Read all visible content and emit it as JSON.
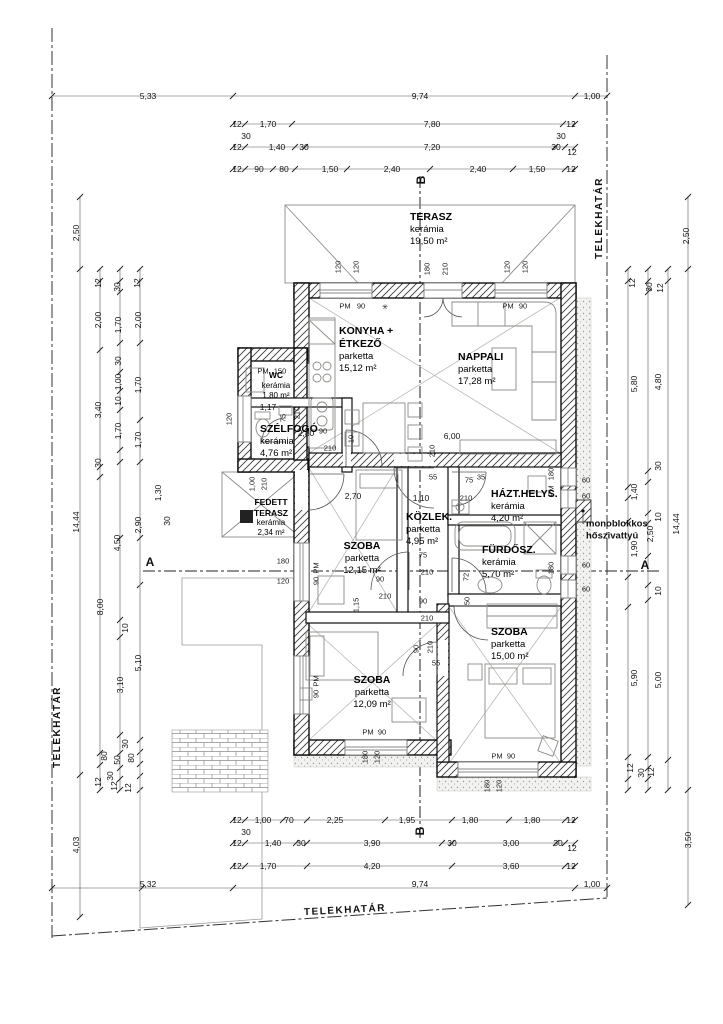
{
  "drawing": {
    "boundary_label": "TELEKHATÁR",
    "annotation": {
      "line1": "monoblokkos",
      "line2": "hőszivattyú"
    },
    "rooms": [
      {
        "name": "TERASZ",
        "floor": "kerámia",
        "area": "19,50 m²",
        "x": 410,
        "y": 211,
        "align": "left",
        "cls": ""
      },
      {
        "name": "KONYHA +",
        "name2": "ÉTKEZŐ",
        "floor": "parketta",
        "area": "15,12 m²",
        "x": 339,
        "y": 325,
        "align": "left",
        "cls": ""
      },
      {
        "name": "NAPPALI",
        "floor": "parketta",
        "area": "17,28 m²",
        "x": 458,
        "y": 351,
        "align": "left",
        "cls": ""
      },
      {
        "name": "WC",
        "floor": "kerámia",
        "area": "1,80 m²",
        "x": 276,
        "y": 370,
        "align": "center",
        "cls": "small"
      },
      {
        "name": "SZÉLFOGÓ",
        "floor": "kerámia",
        "area": "4,76 m²",
        "x": 260,
        "y": 423,
        "align": "left",
        "cls": ""
      },
      {
        "name": "FEDETT",
        "name2": "TERASZ",
        "floor": "kerámia",
        "area": "2,34 m²",
        "x": 271,
        "y": 497,
        "align": "center",
        "cls": "small"
      },
      {
        "name": "SZOBA",
        "floor": "parketta",
        "area": "12,15 m²",
        "x": 362,
        "y": 540,
        "align": "center",
        "cls": ""
      },
      {
        "name": "KÖZLEK.",
        "floor": "parketta",
        "area": "4,95 m²",
        "x": 406,
        "y": 511,
        "align": "left",
        "cls": ""
      },
      {
        "name": "HÁZT.HELYS.",
        "floor": "kerámia",
        "area": "4,20 m²",
        "x": 491,
        "y": 488,
        "align": "left",
        "cls": ""
      },
      {
        "name": "FÜRDŐSZ.",
        "floor": "kerámia",
        "area": "5,70 m²",
        "x": 482,
        "y": 544,
        "align": "left",
        "cls": ""
      },
      {
        "name": "SZOBA",
        "floor": "parketta",
        "area": "12,09 m²",
        "x": 372,
        "y": 674,
        "align": "center",
        "cls": ""
      },
      {
        "name": "SZOBA",
        "floor": "parketta",
        "area": "15,00 m²",
        "x": 491,
        "y": 626,
        "align": "left",
        "cls": ""
      }
    ],
    "labels": [
      {
        "t": "5,33",
        "x": 148,
        "y": 96,
        "c": "dim"
      },
      {
        "t": "9,74",
        "x": 420,
        "y": 96,
        "c": "dim"
      },
      {
        "t": "1,00",
        "x": 592,
        "y": 96,
        "c": "dim"
      },
      {
        "t": "12",
        "x": 237,
        "y": 124,
        "c": "dim"
      },
      {
        "t": "1,70",
        "x": 268,
        "y": 124,
        "c": "dim"
      },
      {
        "t": "7,80",
        "x": 432,
        "y": 124,
        "c": "dim"
      },
      {
        "t": "12",
        "x": 571,
        "y": 124,
        "c": "dim"
      },
      {
        "t": "30",
        "x": 246,
        "y": 136,
        "c": "dim"
      },
      {
        "t": "30",
        "x": 561,
        "y": 136,
        "c": "dim"
      },
      {
        "t": "12",
        "x": 237,
        "y": 147,
        "c": "dim"
      },
      {
        "t": "1,40",
        "x": 277,
        "y": 147,
        "c": "dim"
      },
      {
        "t": "30",
        "x": 304,
        "y": 147,
        "c": "dim"
      },
      {
        "t": "7,20",
        "x": 432,
        "y": 147,
        "c": "dim"
      },
      {
        "t": "30",
        "x": 556,
        "y": 147,
        "c": "dim"
      },
      {
        "t": "12",
        "x": 572,
        "y": 152,
        "c": "dim"
      },
      {
        "t": "12",
        "x": 237,
        "y": 169,
        "c": "dim"
      },
      {
        "t": "90",
        "x": 259,
        "y": 169,
        "c": "dim"
      },
      {
        "t": "80",
        "x": 284,
        "y": 169,
        "c": "dim"
      },
      {
        "t": "1,50",
        "x": 330,
        "y": 169,
        "c": "dim"
      },
      {
        "t": "2,40",
        "x": 392,
        "y": 169,
        "c": "dim"
      },
      {
        "t": "2,40",
        "x": 478,
        "y": 169,
        "c": "dim"
      },
      {
        "t": "1,50",
        "x": 537,
        "y": 169,
        "c": "dim"
      },
      {
        "t": "12",
        "x": 571,
        "y": 169,
        "c": "dim"
      },
      {
        "t": "B",
        "x": 421,
        "y": 180,
        "r": -90,
        "c": "sec"
      },
      {
        "t": "12",
        "x": 237,
        "y": 820,
        "c": "dim"
      },
      {
        "t": "1,00",
        "x": 263,
        "y": 820,
        "c": "dim"
      },
      {
        "t": "70",
        "x": 289,
        "y": 820,
        "c": "dim"
      },
      {
        "t": "2,25",
        "x": 335,
        "y": 820,
        "c": "dim"
      },
      {
        "t": "1,95",
        "x": 407,
        "y": 820,
        "c": "dim"
      },
      {
        "t": "1,80",
        "x": 470,
        "y": 820,
        "c": "dim"
      },
      {
        "t": "1,80",
        "x": 532,
        "y": 820,
        "c": "dim"
      },
      {
        "t": "12",
        "x": 571,
        "y": 820,
        "c": "dim"
      },
      {
        "t": "30",
        "x": 246,
        "y": 832,
        "c": "dim"
      },
      {
        "t": "B",
        "x": 420,
        "y": 831,
        "r": -90,
        "c": "sec"
      },
      {
        "t": "12",
        "x": 237,
        "y": 843,
        "c": "dim"
      },
      {
        "t": "1,40",
        "x": 273,
        "y": 843,
        "c": "dim"
      },
      {
        "t": "30",
        "x": 301,
        "y": 843,
        "c": "dim"
      },
      {
        "t": "3,90",
        "x": 372,
        "y": 843,
        "c": "dim"
      },
      {
        "t": "30",
        "x": 452,
        "y": 843,
        "c": "dim"
      },
      {
        "t": "3,00",
        "x": 511,
        "y": 843,
        "c": "dim"
      },
      {
        "t": "30",
        "x": 558,
        "y": 843,
        "c": "dim"
      },
      {
        "t": "12",
        "x": 572,
        "y": 848,
        "c": "dim"
      },
      {
        "t": "12",
        "x": 237,
        "y": 866,
        "c": "dim"
      },
      {
        "t": "1,70",
        "x": 268,
        "y": 866,
        "c": "dim"
      },
      {
        "t": "4,20",
        "x": 372,
        "y": 866,
        "c": "dim"
      },
      {
        "t": "3,60",
        "x": 511,
        "y": 866,
        "c": "dim"
      },
      {
        "t": "12",
        "x": 571,
        "y": 866,
        "c": "dim"
      },
      {
        "t": "5,32",
        "x": 148,
        "y": 884,
        "c": "dim"
      },
      {
        "t": "9,74",
        "x": 420,
        "y": 884,
        "c": "dim"
      },
      {
        "t": "1,00",
        "x": 592,
        "y": 884,
        "c": "dim"
      },
      {
        "t": "2,50",
        "x": 76,
        "y": 233,
        "r": -90,
        "c": "dim"
      },
      {
        "t": "14,44",
        "x": 76,
        "y": 522,
        "r": -90,
        "c": "dim"
      },
      {
        "t": "4,03",
        "x": 76,
        "y": 845,
        "r": -90,
        "c": "dim"
      },
      {
        "t": "12",
        "x": 98,
        "y": 283,
        "r": -90,
        "c": "dim"
      },
      {
        "t": "30",
        "x": 117,
        "y": 287,
        "r": -90,
        "c": "dim"
      },
      {
        "t": "12",
        "x": 137,
        "y": 283,
        "r": -90,
        "c": "dim"
      },
      {
        "t": "2,00",
        "x": 98,
        "y": 320,
        "r": -90,
        "c": "dim"
      },
      {
        "t": "1,70",
        "x": 118,
        "y": 325,
        "r": -90,
        "c": "dim"
      },
      {
        "t": "2,00",
        "x": 138,
        "y": 320,
        "r": -90,
        "c": "dim"
      },
      {
        "t": "30",
        "x": 118,
        "y": 361,
        "r": -90,
        "c": "dim"
      },
      {
        "t": "1,00",
        "x": 118,
        "y": 382,
        "r": -90,
        "c": "dim"
      },
      {
        "t": "1,70",
        "x": 138,
        "y": 385,
        "r": -90,
        "c": "dim"
      },
      {
        "t": "10",
        "x": 118,
        "y": 401,
        "r": -90,
        "c": "dim"
      },
      {
        "t": "3,40",
        "x": 98,
        "y": 410,
        "r": -90,
        "c": "dim"
      },
      {
        "t": "1,70",
        "x": 118,
        "y": 431,
        "r": -90,
        "c": "dim"
      },
      {
        "t": "1,70",
        "x": 138,
        "y": 440,
        "r": -90,
        "c": "dim"
      },
      {
        "t": "30",
        "x": 98,
        "y": 463,
        "r": -90,
        "c": "dim"
      },
      {
        "t": "1,30",
        "x": 158,
        "y": 493,
        "r": -90,
        "c": "dim"
      },
      {
        "t": "30",
        "x": 167,
        "y": 521,
        "r": -90,
        "c": "dim"
      },
      {
        "t": "2,90",
        "x": 138,
        "y": 525,
        "r": -90,
        "c": "dim"
      },
      {
        "t": "4,50",
        "x": 117,
        "y": 543,
        "r": -90,
        "c": "dim"
      },
      {
        "t": "8,00",
        "x": 100,
        "y": 607,
        "r": -90,
        "c": "dim"
      },
      {
        "t": "10",
        "x": 125,
        "y": 628,
        "r": -90,
        "c": "dim"
      },
      {
        "t": "5,10",
        "x": 138,
        "y": 663,
        "r": -90,
        "c": "dim"
      },
      {
        "t": "3,10",
        "x": 120,
        "y": 685,
        "r": -90,
        "c": "dim"
      },
      {
        "t": "30",
        "x": 125,
        "y": 744,
        "r": -90,
        "c": "dim"
      },
      {
        "t": "80",
        "x": 104,
        "y": 756,
        "r": -90,
        "c": "dim"
      },
      {
        "t": "50",
        "x": 117,
        "y": 760,
        "r": -90,
        "c": "dim"
      },
      {
        "t": "30",
        "x": 110,
        "y": 776,
        "r": -90,
        "c": "dim"
      },
      {
        "t": "12",
        "x": 98,
        "y": 782,
        "r": -90,
        "c": "dim"
      },
      {
        "t": "12",
        "x": 114,
        "y": 786,
        "r": -90,
        "c": "dim"
      },
      {
        "t": "80",
        "x": 131,
        "y": 758,
        "r": -90,
        "c": "dim"
      },
      {
        "t": "12",
        "x": 128,
        "y": 788,
        "r": -90,
        "c": "dim"
      },
      {
        "t": "A",
        "x": 150,
        "y": 562,
        "c": "sec"
      },
      {
        "t": "A",
        "x": 645,
        "y": 565,
        "c": "sec"
      },
      {
        "t": "2,50",
        "x": 686,
        "y": 236,
        "r": -90,
        "c": "dim"
      },
      {
        "t": "12",
        "x": 632,
        "y": 283,
        "r": -90,
        "c": "dim"
      },
      {
        "t": "30",
        "x": 649,
        "y": 287,
        "r": -90,
        "c": "dim"
      },
      {
        "t": "12",
        "x": 660,
        "y": 288,
        "r": -90,
        "c": "dim"
      },
      {
        "t": "5,80",
        "x": 634,
        "y": 384,
        "r": -90,
        "c": "dim"
      },
      {
        "t": "4,80",
        "x": 658,
        "y": 382,
        "r": -90,
        "c": "dim"
      },
      {
        "t": "30",
        "x": 658,
        "y": 466,
        "r": -90,
        "c": "dim"
      },
      {
        "t": "1,40",
        "x": 634,
        "y": 492,
        "r": -90,
        "c": "dim"
      },
      {
        "t": "10",
        "x": 658,
        "y": 517,
        "r": -90,
        "c": "dim"
      },
      {
        "t": "14,44",
        "x": 676,
        "y": 524,
        "r": -90,
        "c": "dim"
      },
      {
        "t": "2,50",
        "x": 650,
        "y": 534,
        "r": -90,
        "c": "dim"
      },
      {
        "t": "1,90",
        "x": 634,
        "y": 549,
        "r": -90,
        "c": "dim"
      },
      {
        "t": "10",
        "x": 658,
        "y": 591,
        "r": -90,
        "c": "dim"
      },
      {
        "t": "5,90",
        "x": 634,
        "y": 678,
        "r": -90,
        "c": "dim"
      },
      {
        "t": "5,00",
        "x": 658,
        "y": 680,
        "r": -90,
        "c": "dim"
      },
      {
        "t": "12",
        "x": 630,
        "y": 768,
        "r": -90,
        "c": "dim"
      },
      {
        "t": "30",
        "x": 641,
        "y": 773,
        "r": -90,
        "c": "dim"
      },
      {
        "t": "12",
        "x": 651,
        "y": 772,
        "r": -90,
        "c": "dim"
      },
      {
        "t": "3,50",
        "x": 688,
        "y": 840,
        "r": -90,
        "c": "dim"
      },
      {
        "t": "TELEKHATÁR",
        "x": 600,
        "y": 218,
        "r": -90,
        "c": "bnd"
      },
      {
        "t": "TELEKHATÁR",
        "x": 58,
        "y": 727,
        "r": -90,
        "c": "bnd"
      },
      {
        "t": "TELEKHATÁR",
        "x": 345,
        "y": 911,
        "r": -3,
        "c": "bnd"
      },
      {
        "t": "monoblokkos",
        "x": 586,
        "y": 524,
        "c": "ann"
      },
      {
        "t": "hőszivattyú",
        "x": 586,
        "y": 536,
        "c": "ann"
      },
      {
        "t": "120",
        "x": 338,
        "y": 267,
        "r": -90,
        "c": "xs"
      },
      {
        "t": "120",
        "x": 356,
        "y": 267,
        "r": -90,
        "c": "xs"
      },
      {
        "t": "180",
        "x": 427,
        "y": 269,
        "r": -90,
        "c": "xs"
      },
      {
        "t": "210",
        "x": 445,
        "y": 269,
        "r": -90,
        "c": "xs"
      },
      {
        "t": "120",
        "x": 507,
        "y": 267,
        "r": -90,
        "c": "xs"
      },
      {
        "t": "120",
        "x": 525,
        "y": 267,
        "r": -90,
        "c": "xs"
      },
      {
        "t": "PM",
        "x": 345,
        "y": 306,
        "c": "xs"
      },
      {
        "t": "90",
        "x": 361,
        "y": 306,
        "c": "xs"
      },
      {
        "t": "✳",
        "x": 385,
        "y": 307,
        "c": "xs"
      },
      {
        "t": "PM",
        "x": 508,
        "y": 306,
        "c": "xs"
      },
      {
        "t": "90",
        "x": 523,
        "y": 306,
        "c": "xs"
      },
      {
        "t": "PM",
        "x": 263,
        "y": 371,
        "c": "xs"
      },
      {
        "t": "150",
        "x": 280,
        "y": 371,
        "c": "xs"
      },
      {
        "t": "1,17",
        "x": 268,
        "y": 407,
        "c": "dim"
      },
      {
        "t": "120",
        "x": 229,
        "y": 419,
        "r": -90,
        "c": "xs"
      },
      {
        "t": "75",
        "x": 283,
        "y": 418,
        "r": -90,
        "c": "xs"
      },
      {
        "t": "210",
        "x": 297,
        "y": 413,
        "r": -90,
        "c": "xs"
      },
      {
        "t": "2,80",
        "x": 306,
        "y": 433,
        "c": "dim"
      },
      {
        "t": "90",
        "x": 323,
        "y": 431,
        "c": "xs"
      },
      {
        "t": "210",
        "x": 330,
        "y": 448,
        "c": "xs"
      },
      {
        "t": "10",
        "x": 351,
        "y": 439,
        "r": -90,
        "c": "xs"
      },
      {
        "t": "1,00",
        "x": 252,
        "y": 484,
        "r": -90,
        "c": "xs"
      },
      {
        "t": "210",
        "x": 264,
        "y": 484,
        "r": -90,
        "c": "xs"
      },
      {
        "t": "6,00",
        "x": 452,
        "y": 436,
        "c": "dim"
      },
      {
        "t": "210",
        "x": 432,
        "y": 451,
        "r": -90,
        "c": "xs"
      },
      {
        "t": "2,70",
        "x": 353,
        "y": 496,
        "c": "dim"
      },
      {
        "t": "1,15",
        "x": 356,
        "y": 605,
        "r": -90,
        "c": "xs"
      },
      {
        "t": "90",
        "x": 380,
        "y": 579,
        "c": "xs"
      },
      {
        "t": "210",
        "x": 385,
        "y": 596,
        "c": "xs"
      },
      {
        "t": "180",
        "x": 283,
        "y": 561,
        "c": "xs"
      },
      {
        "t": "120",
        "x": 283,
        "y": 581,
        "c": "xs"
      },
      {
        "t": "PM",
        "x": 316,
        "y": 568,
        "r": -90,
        "c": "xs"
      },
      {
        "t": "90",
        "x": 316,
        "y": 581,
        "r": -90,
        "c": "xs"
      },
      {
        "t": "PM",
        "x": 316,
        "y": 681,
        "r": -90,
        "c": "xs"
      },
      {
        "t": "90",
        "x": 316,
        "y": 694,
        "r": -90,
        "c": "xs"
      },
      {
        "t": "55",
        "x": 433,
        "y": 477,
        "c": "xs"
      },
      {
        "t": "75",
        "x": 469,
        "y": 480,
        "c": "xs"
      },
      {
        "t": "35",
        "x": 481,
        "y": 477,
        "c": "xs"
      },
      {
        "t": "1,10",
        "x": 421,
        "y": 498,
        "c": "dim"
      },
      {
        "t": "210",
        "x": 466,
        "y": 498,
        "c": "xs"
      },
      {
        "t": "75",
        "x": 423,
        "y": 555,
        "c": "xs"
      },
      {
        "t": "210",
        "x": 427,
        "y": 572,
        "c": "xs"
      },
      {
        "t": "72",
        "x": 466,
        "y": 577,
        "r": -90,
        "c": "xs"
      },
      {
        "t": "90",
        "x": 423,
        "y": 601,
        "c": "xs"
      },
      {
        "t": "50",
        "x": 467,
        "y": 601,
        "r": -90,
        "c": "xs"
      },
      {
        "t": "210",
        "x": 427,
        "y": 618,
        "c": "xs"
      },
      {
        "t": "90",
        "x": 416,
        "y": 649,
        "r": -90,
        "c": "xs"
      },
      {
        "t": "210",
        "x": 430,
        "y": 647,
        "r": -90,
        "c": "xs"
      },
      {
        "t": "55",
        "x": 436,
        "y": 663,
        "c": "xs"
      },
      {
        "t": "180",
        "x": 551,
        "y": 474,
        "r": -90,
        "c": "xs"
      },
      {
        "t": "PM",
        "x": 551,
        "y": 491,
        "r": -90,
        "c": "xs"
      },
      {
        "t": "180",
        "x": 551,
        "y": 568,
        "r": -90,
        "c": "xs"
      },
      {
        "t": "60",
        "x": 586,
        "y": 480,
        "c": "xs"
      },
      {
        "t": "60",
        "x": 586,
        "y": 496,
        "c": "xs"
      },
      {
        "t": "60",
        "x": 586,
        "y": 565,
        "c": "xs"
      },
      {
        "t": "60",
        "x": 586,
        "y": 589,
        "c": "xs"
      },
      {
        "t": "PM",
        "x": 368,
        "y": 732,
        "c": "xs"
      },
      {
        "t": "90",
        "x": 382,
        "y": 732,
        "c": "xs"
      },
      {
        "t": "180",
        "x": 365,
        "y": 757,
        "r": -90,
        "c": "xs"
      },
      {
        "t": "120",
        "x": 377,
        "y": 757,
        "r": -90,
        "c": "xs"
      },
      {
        "t": "PM",
        "x": 497,
        "y": 756,
        "c": "xs"
      },
      {
        "t": "90",
        "x": 511,
        "y": 756,
        "c": "xs"
      },
      {
        "t": "180",
        "x": 487,
        "y": 786,
        "r": -90,
        "c": "xs"
      },
      {
        "t": "120",
        "x": 499,
        "y": 786,
        "r": -90,
        "c": "xs"
      }
    ]
  }
}
